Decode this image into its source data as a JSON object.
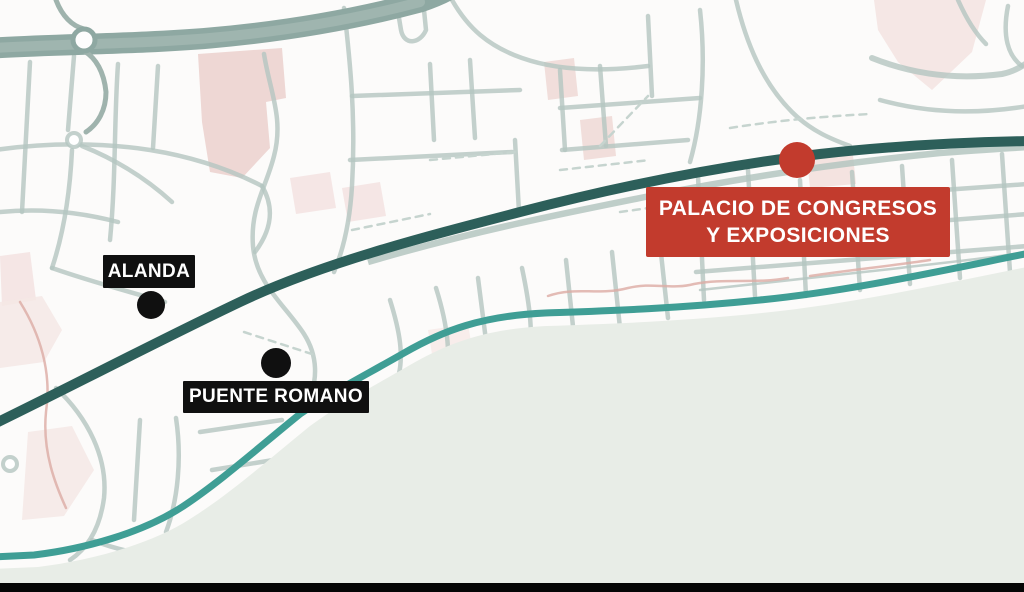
{
  "markers": [
    {
      "label": "ALANDA",
      "label_bg": "#101010",
      "dot_color": "#101010"
    },
    {
      "label": "PUENTE ROMANO",
      "label_bg": "#101010",
      "dot_color": "#101010"
    },
    {
      "label_line1": "PALACIO DE CONGRESOS",
      "label_line2": "Y EXPOSICIONES",
      "label_bg": "#c23b2d",
      "dot_color": "#c23b2d"
    }
  ],
  "colors": {
    "land": "#fcfbfa",
    "sea": "#e8ede7",
    "coastline": "#3f9e95",
    "main_road": "#2d5f5a",
    "highway": "#8ea8a2",
    "highway_core": "#9fb5af",
    "streets": "#b4c6c0",
    "streets_faint": "#c6d4cf",
    "pink_area": "#ecd2ce",
    "pink_road": "#dcaba4",
    "label_text": "#ffffff",
    "bottom_bar": "#050505"
  }
}
